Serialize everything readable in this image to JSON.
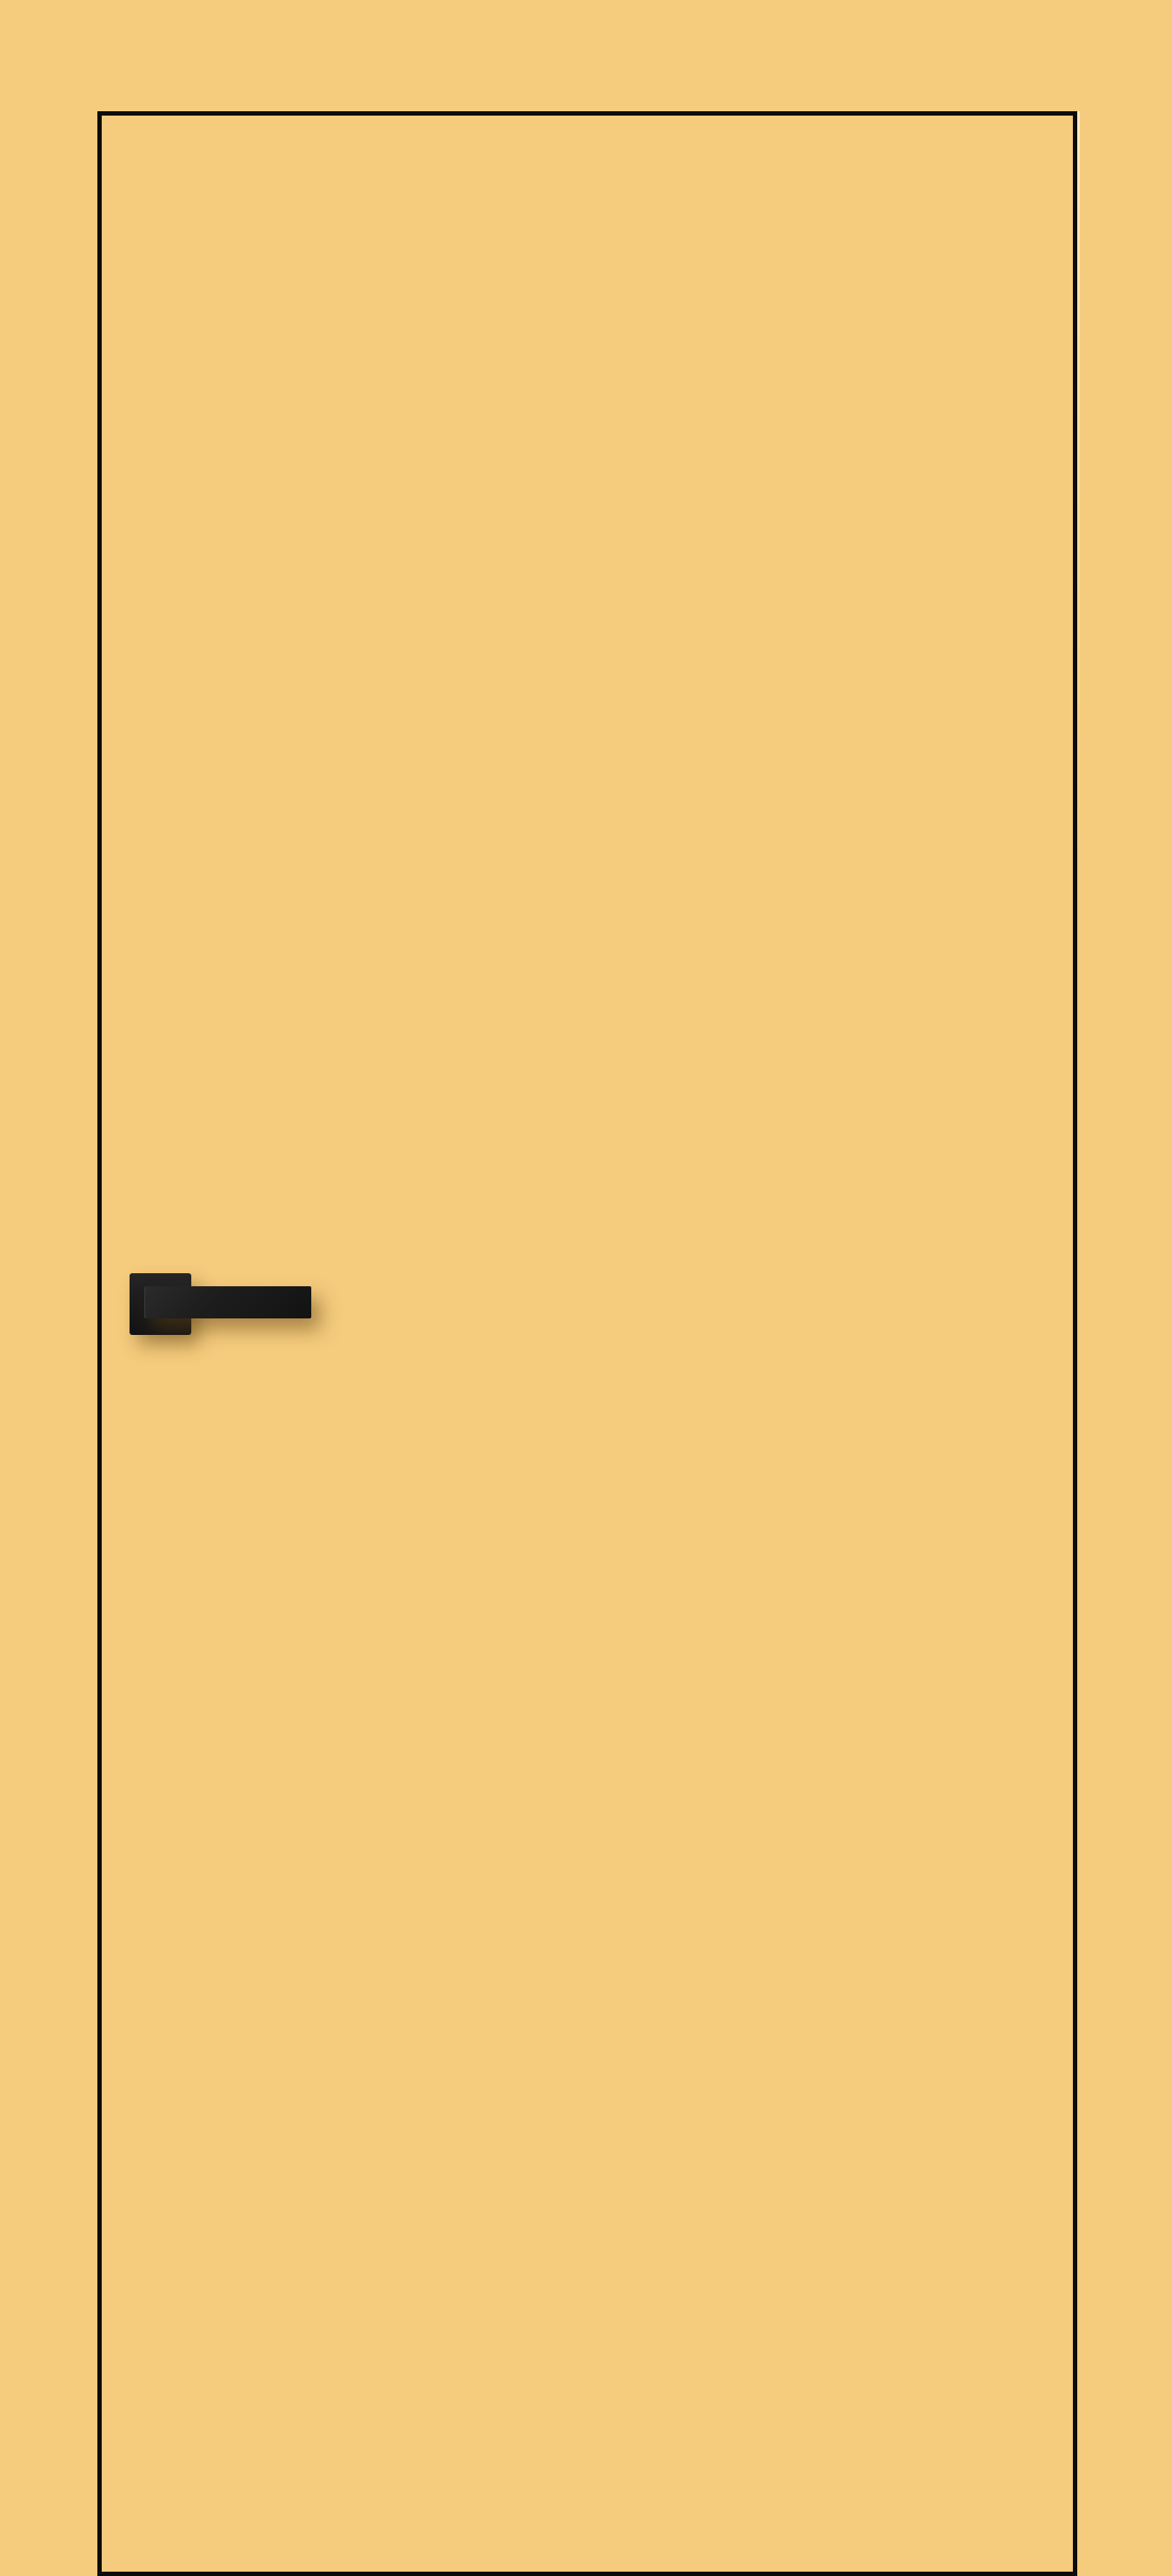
{
  "scene": {
    "type": "product-image",
    "subject": "flush interior door leaf with black edge trim and black square-rosette lever handle",
    "handle_side": "left",
    "text_content": "none"
  },
  "colors": {
    "background": "#F5CB7D",
    "door_face": "#F5CB7D",
    "door_edge_line": "#0D0C09",
    "handle_dark": "#1C1C1C",
    "handle_edge_highlight": "#3A3A3A",
    "cast_shadow": "rgba(96,66,18,0.5)"
  }
}
